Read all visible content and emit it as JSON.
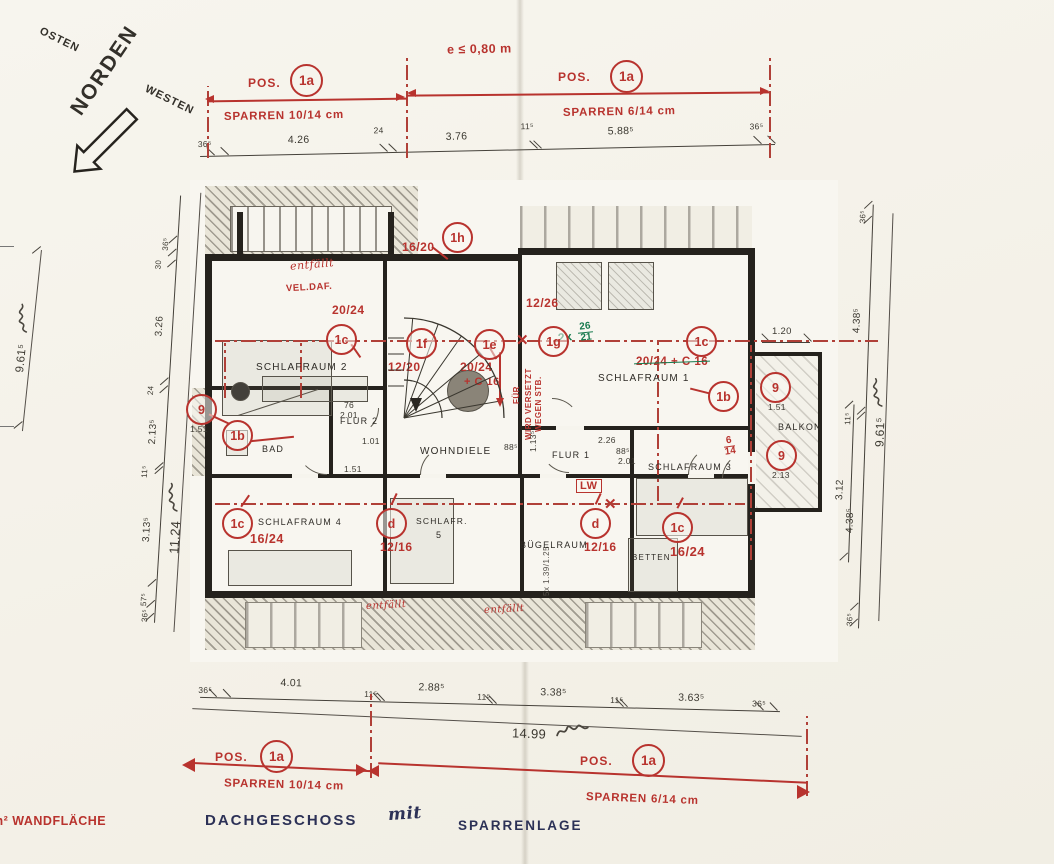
{
  "compass": {
    "n": "NORDEN",
    "e": "OSTEN",
    "w": "WESTEN"
  },
  "header": {
    "eaves": "e ≤ 0,80 m"
  },
  "pos": {
    "prefix": "POS.",
    "id": "1a",
    "left": "SPARREN 10/14 cm",
    "right": "SPARREN 6/14 cm"
  },
  "top_chain": {
    "v": [
      "36⁵",
      "4.26",
      "24",
      "3.76",
      "11⁵",
      "5.88⁵",
      "36⁵"
    ]
  },
  "bottom_chain": {
    "v": [
      "36⁵",
      "4.01",
      "11⁵",
      "2.88⁵",
      "11⁵",
      "3.38⁵",
      "11⁵",
      "3.63⁵",
      "36⁵"
    ],
    "total": "14.99"
  },
  "left_chain": {
    "v": [
      "36⁵",
      "30",
      "3.26",
      "24",
      "2.13⁵",
      "11⁵",
      "3.13⁵",
      "57⁵",
      "36⁵"
    ],
    "total": "11.24"
  },
  "right_chain": {
    "v": [
      "36⁵",
      "4.38⁵",
      "11⁵",
      "4.38⁵",
      "36⁵"
    ],
    "total": "9.61⁵",
    "balc_h": "3.12",
    "balc_w": "1.20"
  },
  "farleft": {
    "total": "9.61⁵"
  },
  "rooms": {
    "schlafraum2": "SCHLAFRAUM 2",
    "flur2": "FLUR 2",
    "bad": "BAD",
    "schlafraum4": "SCHLAFRAUM 4",
    "schlafr5a": "SCHLAFR.",
    "schlafr5b": "5",
    "wohndiele": "WOHNDIELE",
    "flur1": "FLUR 1",
    "buegelraum": "BÜGELRAUM",
    "betten": "BETTEN",
    "schlafraum1": "SCHLAFRAUM 1",
    "schlafraum3": "SCHLAFRAUM 3",
    "balkon": "BALKON"
  },
  "markers": [
    {
      "id": "1h"
    },
    {
      "id": "1c"
    },
    {
      "id": "1f"
    },
    {
      "id": "1e"
    },
    {
      "id": "1g"
    },
    {
      "id": "1c"
    },
    {
      "id": "1b"
    },
    {
      "id": "9",
      "note": "1.51"
    },
    {
      "id": "9",
      "note": "2.13"
    },
    {
      "id": "9",
      "note": "1.51"
    },
    {
      "id": "1b"
    },
    {
      "id": "1c",
      "note": "16/24"
    },
    {
      "id": "d",
      "note": "12/16"
    },
    {
      "id": "d",
      "note": "12/16"
    },
    {
      "id": "1c",
      "note": "16/24"
    }
  ],
  "notes": {
    "n1620": "16/20",
    "n2024a": "20/24",
    "n1220": "12/20",
    "n2024b": "20/24",
    "nc16": "+ C 16",
    "n1226": "12/26",
    "n2024c16": "20/24 + C 16",
    "n6": "6",
    "n14": "14",
    "lw": "LW",
    "fuer": "FÜR",
    "versetzt": "WIRD VERSETZT",
    "wegen": "WEGEN STB.",
    "gpre": "2x",
    "gtop": "26",
    "gbot": "21",
    "entf1": "entfällt",
    "veldaf": "VEL.DAF.",
    "entf2": "entfällt",
    "entf3": "entfällt",
    "stairs": "5x 1.39/1.25",
    "x1": "✕",
    "x2": "✕"
  },
  "sd": {
    "a": "76",
    "b": "2.01",
    "c": "1.01",
    "d": "1.51",
    "e": "2.26",
    "f": "88⁵",
    "g": "1.13⁵",
    "h": "88⁵",
    "i": "2.01"
  },
  "footer": {
    "t1": "DACHGESCHOSS",
    "t2": "mit",
    "t3": "SPARRENLAGE",
    "note": "m² WANDFLÄCHE"
  }
}
